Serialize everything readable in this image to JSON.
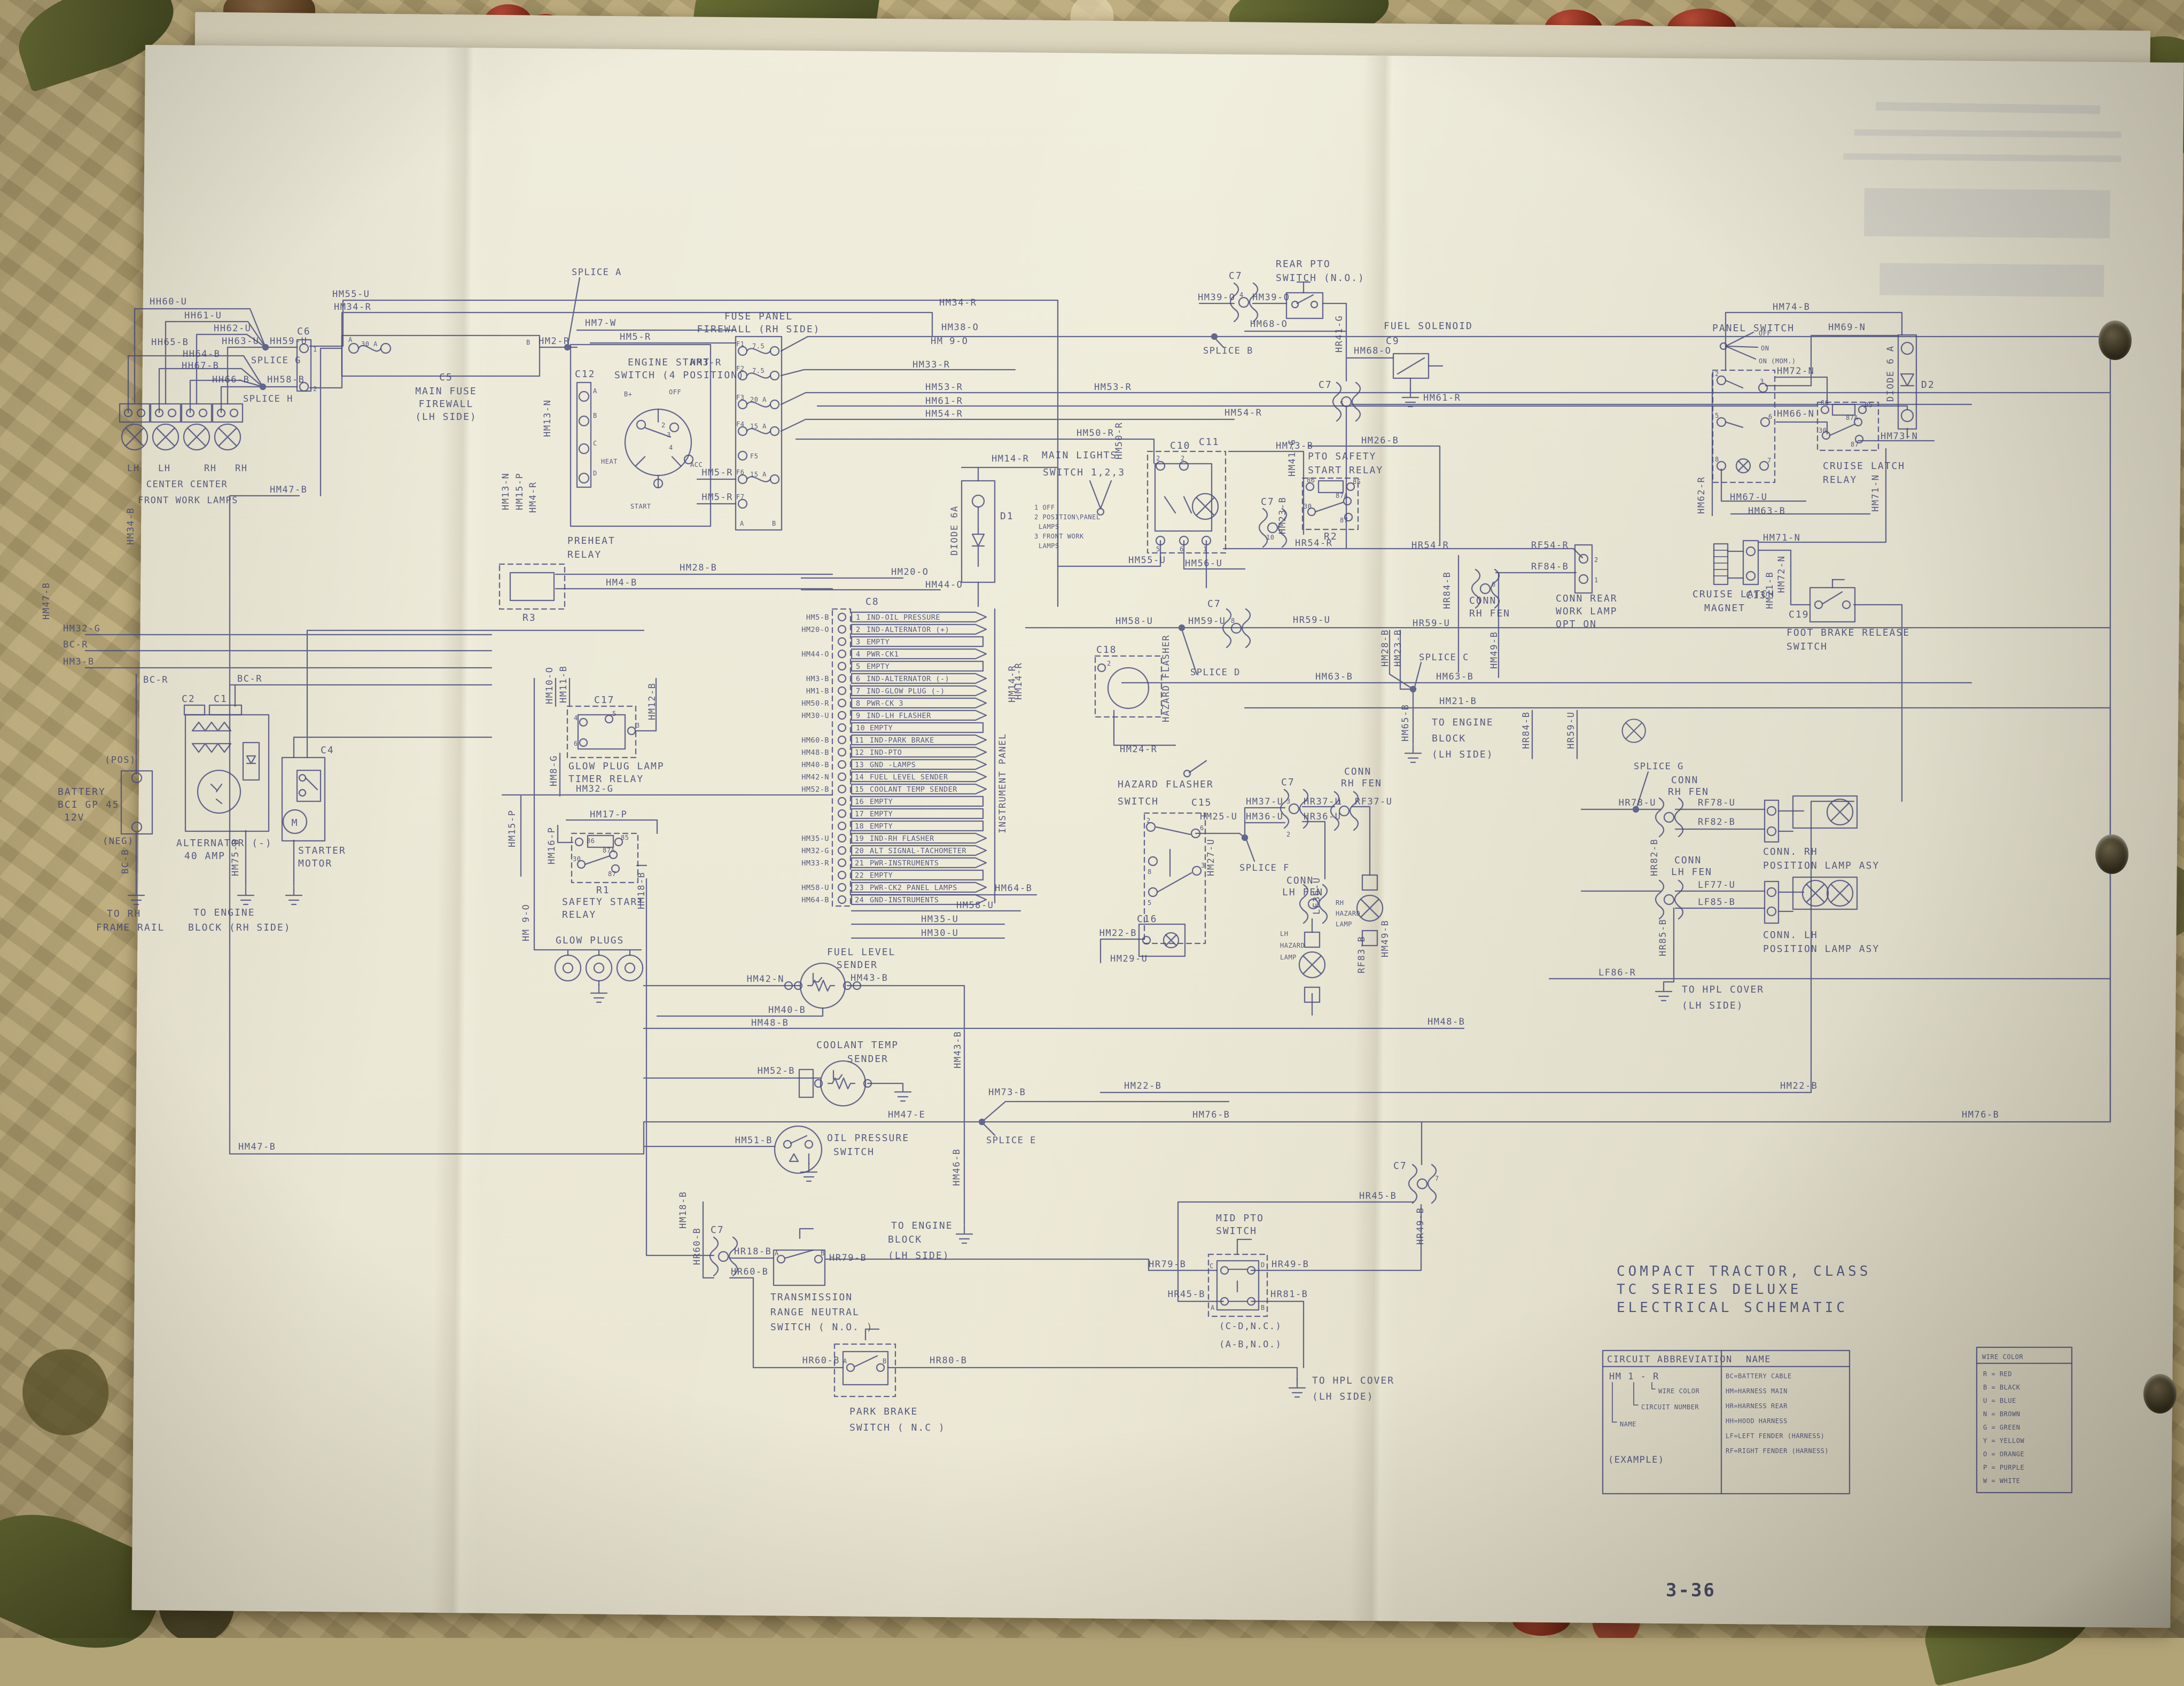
{
  "page": {
    "number": "3-36"
  },
  "title": {
    "l1": "COMPACT TRACTOR, CLASS",
    "l2": "TC SERIES DELUXE",
    "l3": "ELECTRICAL SCHEMATIC"
  },
  "legend": {
    "h_abbrev": "CIRCUIT ABBREVIATION",
    "h_name": "NAME",
    "h_color": "WIRE COLOR",
    "ex_code": "HM  1 - R",
    "ex_color": "WIRE COLOR",
    "ex_circuit": "CIRCUIT NUMBER",
    "ex_name": "NAME",
    "ex_caption": "(EXAMPLE)",
    "names": [
      "BC=BATTERY CABLE",
      "HM=HARNESS MAIN",
      "HR=HARNESS REAR",
      "HH=HOOD HARNESS",
      "LF=LEFT FENDER (HARNESS)",
      "RF=RIGHT FENDER (HARNESS)"
    ],
    "colors": [
      "R = RED",
      "B = BLACK",
      "U = BLUE",
      "N = BROWN",
      "G = GREEN",
      "Y = YELLOW",
      "O = ORANGE",
      "P = PURPLE",
      "W = WHITE"
    ]
  },
  "pin": {
    "a": "A",
    "b": "B",
    "c": "C",
    "d": "D",
    "n1": "1",
    "n2": "2",
    "n3": "3",
    "n4": "4",
    "n5": "5",
    "n6": "6",
    "n7": "7",
    "n8": "8",
    "n10": "10",
    "r30": "30",
    "r85": "85",
    "r86": "86",
    "r87": "87",
    "r87a": "87A"
  },
  "fp": {
    "l1": "FUSE PANEL",
    "l2": "FIREWALL (RH SIDE)",
    "rows": [
      {
        "id": "F1",
        "a": "7.5"
      },
      {
        "id": "F2",
        "a": "7.5"
      },
      {
        "id": "F3",
        "a": "20 A"
      },
      {
        "id": "F4",
        "a": "15 A"
      },
      {
        "id": "F5",
        "a": ""
      },
      {
        "id": "F6",
        "a": "15 A"
      },
      {
        "id": "F7",
        "a": ""
      }
    ]
  },
  "c8": {
    "id": "C8",
    "panel": "INSTRUMENT PANEL",
    "panel_wire": "HM14-R",
    "rows": [
      {
        "n": "1",
        "t": "IND-OIL PRESSURE",
        "w": "HM5-B"
      },
      {
        "n": "2",
        "t": "IND-ALTERNATOR (+)",
        "w": "HM20-O"
      },
      {
        "n": "3",
        "t": "EMPTY"
      },
      {
        "n": "4",
        "t": "PWR-CK1",
        "w": "HM44-O"
      },
      {
        "n": "5",
        "t": "EMPTY"
      },
      {
        "n": "6",
        "t": "IND-ALTERNATOR (-)",
        "w": "HM3-B"
      },
      {
        "n": "7",
        "t": "IND-GLOW PLUG (-)",
        "w": "HM1-B"
      },
      {
        "n": "8",
        "t": "PWR-CK 3",
        "w": "HM50-R"
      },
      {
        "n": "9",
        "t": "IND-LH FLASHER",
        "w": "HM30-U"
      },
      {
        "n": "10",
        "t": "EMPTY"
      },
      {
        "n": "11",
        "t": "IND-PARK BRAKE",
        "w": "HM60-B"
      },
      {
        "n": "12",
        "t": "IND-PTO",
        "w": "HM48-B"
      },
      {
        "n": "13",
        "t": "GND -LAMPS",
        "w": "HM40-B"
      },
      {
        "n": "14",
        "t": "FUEL LEVEL SENDER",
        "w": "HM42-N"
      },
      {
        "n": "15",
        "t": "COOLANT TEMP SENDER",
        "w": "HM52-B"
      },
      {
        "n": "16",
        "t": "EMPTY"
      },
      {
        "n": "17",
        "t": "EMPTY"
      },
      {
        "n": "18",
        "t": "EMPTY"
      },
      {
        "n": "19",
        "t": "IND-RH FLASHER",
        "w": "HM35-U"
      },
      {
        "n": "20",
        "t": "ALT SIGNAL-TACHOMETER",
        "w": "HM32-G"
      },
      {
        "n": "21",
        "t": "PWR-INSTRUMENTS",
        "w": "HM33-R"
      },
      {
        "n": "22",
        "t": "EMPTY"
      },
      {
        "n": "23",
        "t": "PWR-CK2 PANEL LAMPS",
        "w": "HM58-U"
      },
      {
        "n": "24",
        "t": "GND-INSTRUMENTS",
        "w": "HM64-B"
      }
    ]
  },
  "comp": {
    "front_lamps": {
      "p1": "LH",
      "p2": "LH",
      "p3": "RH",
      "p4": "RH",
      "c1": "CENTER CENTER",
      "c2": "FRONT WORK LAMPS"
    },
    "c6": {
      "id": "C6"
    },
    "c5": {
      "id": "C5",
      "l1": "MAIN FUSE",
      "l2": "FIREWALL",
      "l3": "(LH SIDE)",
      "amp": "30 A"
    },
    "c12": {
      "id": "C12"
    },
    "ess": {
      "l1": "ENGINE START",
      "l2": "SWITCH (4 POSITION)",
      "off": "OFF",
      "heat": "HEAT",
      "acc": "ACC",
      "start": "START",
      "bp": "B+"
    },
    "d1": {
      "v": "DIODE 6A",
      "id": "D1"
    },
    "d2": {
      "v": "DIODE 6 A",
      "id": "D2"
    },
    "preheat": {
      "l1": "PREHEAT",
      "l2": "RELAY",
      "id": "R3"
    },
    "mls": {
      "l1": "MAIN LIGHTS",
      "l2": "SWITCH 1,2,3",
      "o1": "1 OFF",
      "o2": "2 POSITION\\PANEL",
      "o3": "LAMPS",
      "o4": "3 FRONT WORK",
      "o5": "LAMPS",
      "c10": "C10",
      "c11": "C11"
    },
    "rpto": {
      "l1": "REAR PTO",
      "l2": "SWITCH (N.O.)"
    },
    "fsol": {
      "l1": "FUEL SOLENOID",
      "id": "C9"
    },
    "ptor": {
      "l1": "PTO SAFETY",
      "l2": "START RELAY",
      "id": "R2"
    },
    "ps": {
      "l1": "PANEL SWITCH",
      "off": "OFF",
      "on": "ON",
      "onm": "ON (MOM.)"
    },
    "clr": {
      "l1": "CRUISE LATCH",
      "l2": "RELAY"
    },
    "clm": {
      "l1": "CRUISE LATCH",
      "l2": "MAGNET",
      "id": "C13"
    },
    "fbr": {
      "l1": "FOOT BRAKE RELEASE",
      "l2": "SWITCH",
      "id": "C19"
    },
    "hfs": {
      "l1": "HAZARD FLASHER",
      "l2": "SWITCH",
      "c15": "C15",
      "c16": "C16"
    },
    "hf": {
      "id": "C18",
      "v": "HAZARD FLASHER"
    },
    "battery": {
      "l1": "BATTERY",
      "l2": "BCI GP 45",
      "l3": "12V",
      "pos": "(POS)",
      "neg": "(NEG)",
      "g1": "TO RH",
      "g2": "FRAME RAIL"
    },
    "alt": {
      "l1": "ALTERNATOR (-)",
      "l2": "40 AMP",
      "c1": "C1",
      "c2": "C2",
      "g1": "TO ENGINE",
      "g2": "BLOCK (RH SIDE)"
    },
    "starter": {
      "l1": "STARTER",
      "l2": "MOTOR",
      "id": "C4",
      "m": "M"
    },
    "gpr": {
      "id": "C17",
      "l1": "GLOW PLUG LAMP",
      "l2": "TIMER RELAY"
    },
    "ssr": {
      "id": "R1",
      "l1": "SAFETY START",
      "l2": "RELAY"
    },
    "gp": {
      "l1": "GLOW PLUGS"
    },
    "fls": {
      "l1": "FUEL LEVEL",
      "l2": "SENDER"
    },
    "cts": {
      "l1": "COOLANT TEMP",
      "l2": "SENDER"
    },
    "ops": {
      "l1": "OIL PRESSURE",
      "l2": "SWITCH"
    },
    "trn": {
      "l1": "TRANSMISSION",
      "l2": "RANGE NEUTRAL",
      "l3": "SWITCH ( N.O. )"
    },
    "pbs": {
      "l1": "PARK BRAKE",
      "l2": "SWITCH ( N.C )"
    },
    "mpto": {
      "l1": "MID  PTO",
      "l2": "SWITCH",
      "n1": "(C-D,N.C.)",
      "n2": "(A-B,N.O.)"
    },
    "crw": {
      "l1": "CONN REAR",
      "l2": "WORK LAMP",
      "l3": "OPT ON"
    },
    "connrh": {
      "l1": "CONN",
      "l2": "RH FEN"
    },
    "connlh": {
      "l1": "CONN",
      "l2": "LH FEN"
    },
    "rhpl": {
      "l1": "CONN. RH",
      "l2": "POSITION LAMP ASY"
    },
    "lhpl": {
      "l1": "CONN. LH",
      "l2": "POSITION LAMP ASY"
    },
    "rhz": {
      "l1": "RH",
      "l2": "HAZARD",
      "l3": "LAMP"
    },
    "lhz": {
      "l1": "LH",
      "l2": "HAZARD",
      "l3": "LAMP"
    },
    "g_eng_lh": {
      "l1": "TO ENGINE",
      "l2": "BLOCK",
      "l3": "(LH SIDE)"
    },
    "g_hpl": {
      "l1": "TO HPL COVER",
      "l2": "(LH SIDE)"
    },
    "c7": {
      "id": "C7"
    }
  },
  "w": {
    "HH60_U": "HH60-U",
    "HH61_U": "HH61-U",
    "HH62_U": "HH62-U",
    "HH63_U": "HH63-U",
    "HH64_B": "HH64-B",
    "HH65_B": "HH65-B",
    "HH66_B": "HH66-B",
    "HH67_B": "HH67-B",
    "HH59_U": "HH59-U",
    "HH58_B": "HH58-B",
    "SPLICE_A": "SPLICE A",
    "SPLICE_B": "SPLICE B",
    "SPLICE_C": "SPLICE C",
    "SPLICE_D": "SPLICE D",
    "SPLICE_E": "SPLICE E",
    "SPLICE_F": "SPLICE F",
    "SPLICE_G": "SPLICE G",
    "SPLICE_H": "SPLICE H",
    "HM55_U": "HM55-U",
    "HM34_R": "HM34-R",
    "HM34_B": "HM34-B",
    "HM47_B": "HM47-B",
    "HM47_E": "HM47-E",
    "HM2_R": "HM2-R",
    "HM7_W": "HM7-W",
    "HM5_R": "HM5-R",
    "HM3_R": "HM3-R",
    "HM13_N": "HM13-N",
    "HM15_P": "HM15-P",
    "HM4_R": "HM4-R",
    "HM4_B": "HM4-B",
    "HM28_B": "HM28-B",
    "HM33_R": "HM33-R",
    "HM38_O": "HM38-O",
    "HM9_O": "HM 9-O",
    "HM53_R": "HM53-R",
    "HM61_R": "HM61-R",
    "HM54_R": "HM54-R",
    "HM50_R": "HM50-R",
    "HM14_R": "HM14-R",
    "HM39_O": "HM39-O",
    "HM68_O": "HM68-O",
    "HR41_G": "HR41-G",
    "HM26_B": "HM26-B",
    "HM73_B": "HM73-B",
    "HM56_U": "HM56-U",
    "HM58_U": "HM58-U",
    "HM59_U": "HM59-U",
    "HR59_U": "HR59-U",
    "HR54_R": "HR54-R",
    "RF54_R": "RF54-R",
    "RF84_B": "RF84-B",
    "HR84_B": "HR84-B",
    "HM41_G": "HM41-G",
    "HM23_B": "HM23-B",
    "HM63_B": "HM63-B",
    "HM21_B": "HM21-B",
    "HM65_B": "HM65-B",
    "HM49_B": "HM49-B",
    "HM74_B": "HM74-B",
    "HM69_N": "HM69-N",
    "HM72_N": "HM72-N",
    "HM66_N": "HM66-N",
    "HM67_U": "HM67-U",
    "HM62_R": "HM62-R",
    "HM71_N": "HM71-N",
    "HM73_N": "HM73-N",
    "HM30_U": "HM30-U",
    "HM35_U": "HM35-U",
    "HM32_G": "HM32-G",
    "HM3_B": "HM3-B",
    "HM20_O": "HM20-O",
    "HM44_O": "HM44-O",
    "HM60_B": "HM60-B",
    "HM48_B": "HM48-B",
    "HM40_B": "HM40-B",
    "HM42_N": "HM42-N",
    "HM43_B": "HM43-B",
    "HM52_B": "HM52-B",
    "HM64_B": "HM64-B",
    "HM24_R": "HM24-R",
    "HM22_B": "HM22-B",
    "HM29_U": "HM29-U",
    "HM27_U": "HM27-U",
    "HM25_U": "HM25-U",
    "HM37_U": "HM37-U",
    "HM36_U": "HM36-U",
    "HR37_U": "HR37-U",
    "HR36_U": "HR36-U",
    "RF37_U": "RF37-U",
    "LF36_U": "LF36-U",
    "HR78_U": "HR78-U",
    "RF78_U": "RF78-U",
    "RF82_B": "RF82-B",
    "HR82_B": "HR82-B",
    "LF77_U": "LF77-U",
    "LF85_B": "LF85-B",
    "HR85_B": "HR85-B",
    "LF86_R": "LF86-R",
    "RF83_B": "RF83-B",
    "HM46_B": "HM46-B",
    "HM76_B": "HM76-B",
    "HM18_B": "HM18-B",
    "HR18_B": "HR18-B",
    "HR79_B": "HR79-B",
    "HR60_B": "HR60-B",
    "HR80_B": "HR80-B",
    "HR45_B": "HR45-B",
    "HR49_B": "HR49-B",
    "HR81_B": "HR81-B",
    "HM17_P": "HM17-P",
    "HM16_P": "HM16-P",
    "HM10_O": "HM10-O",
    "HM11_B": "HM11-B",
    "HM12_B": "HM12-B",
    "HM8_G": "HM8-G",
    "HM75_B": "HM75-B",
    "BC_R": "BC-R",
    "BC_B": "BC-B",
    "HM51_B": "HM51-B"
  }
}
